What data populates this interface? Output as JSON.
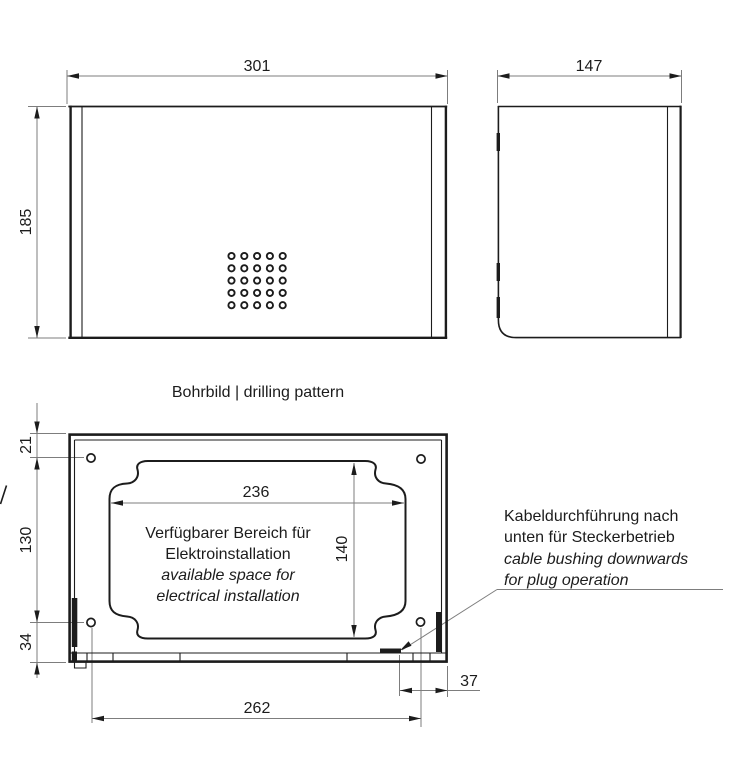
{
  "front_view": {
    "width": "301",
    "height": "185",
    "perforation": {
      "rows": 5,
      "cols": 5
    }
  },
  "side_view": {
    "depth": "147"
  },
  "drilling": {
    "title": "Bohrbild | drilling pattern",
    "hole_top_offset": "21",
    "hole_vertical_spacing": "130",
    "hole_bottom_offset": "34",
    "space_width": "236",
    "space_height": "140",
    "hole_horizontal_spacing": "262",
    "bushing_offset": "37",
    "available_space": {
      "de_line1": "Verfügbarer Bereich für",
      "de_line2": "Elektroinstallation",
      "en_line1": "available space for",
      "en_line2": "electrical installation"
    },
    "bushing_note": {
      "de_line1": "Kabeldurchführung nach",
      "de_line2": "unten für Steckerbetrieb",
      "en_line1": "cable bushing downwards",
      "en_line2": "for plug operation"
    }
  },
  "colors": {
    "line": "#1c1c1c",
    "dim_line": "#7d7d7d",
    "background": "#ffffff"
  }
}
